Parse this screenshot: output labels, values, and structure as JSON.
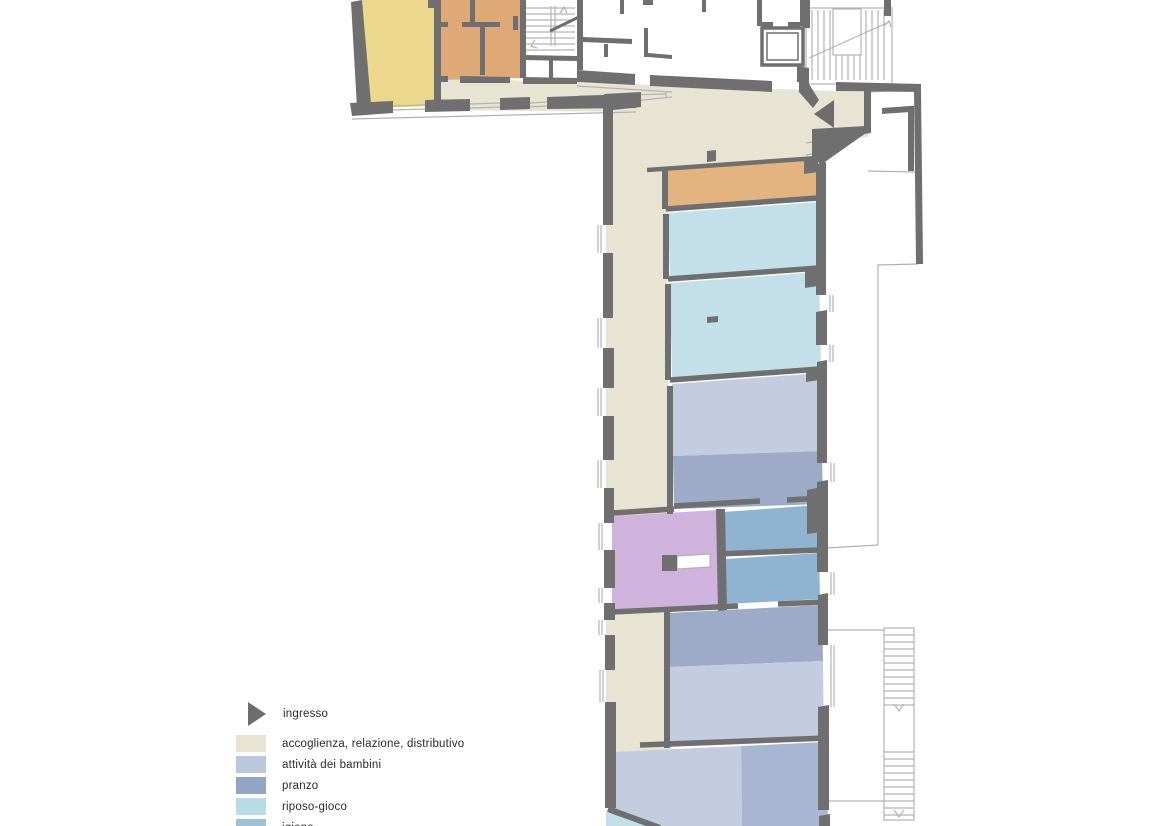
{
  "legend": {
    "entries": [
      {
        "label": "ingresso",
        "color": "#6d6d6d",
        "marker": "arrow"
      },
      {
        "label": "accoglienza, relazione, distributivo",
        "color": "#e8e4d4"
      },
      {
        "label": "attività dei bambini",
        "color": "#bcc6dc"
      },
      {
        "label": "pranzo",
        "color": "#93a5c4"
      },
      {
        "label": "riposo-gioco",
        "color": "#b9dce8"
      },
      {
        "label": "igiene",
        "color": "#9fc0d6"
      }
    ]
  },
  "colors": {
    "accoglienza": "#e8e4d4",
    "attivita": "#c4cce0",
    "attivita_dark": "#a9b6d3",
    "pranzo": "#9dabc9",
    "riposo": "#c3dfe9",
    "igiene": "#8fb3d1",
    "giallo": "#ecd88c",
    "arancio": "#dfa877",
    "arancio_chiaro": "#e4b480",
    "viola": "#cfb3dc",
    "muro": "#6f6f6f",
    "linea": "#b3b3b3",
    "bianco": "#ffffff",
    "freccia": "#6d6d6d"
  }
}
